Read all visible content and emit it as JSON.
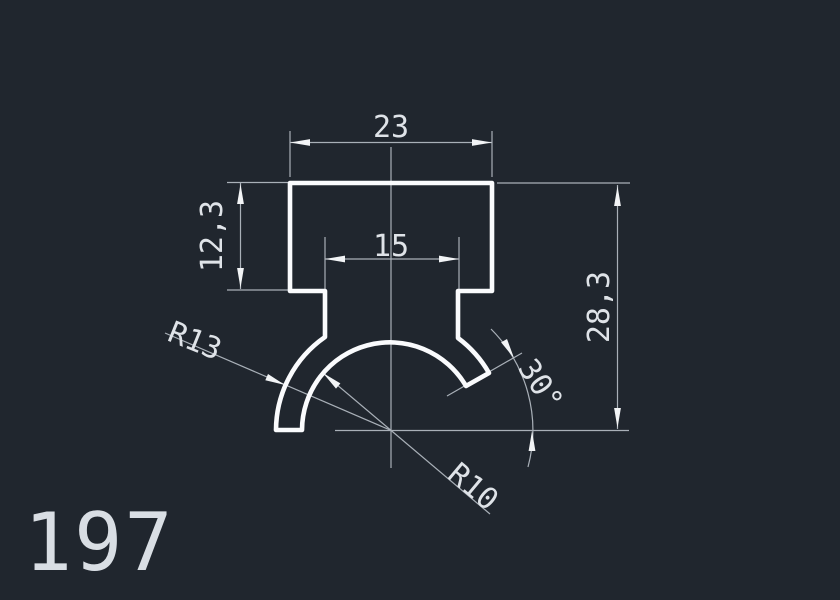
{
  "drawing": {
    "part_number": "197",
    "dimensions": {
      "top_width": "23",
      "slot_width": "15",
      "head_height": "12,3",
      "total_height": "28,3",
      "outer_radius": "R13",
      "inner_radius": "R10",
      "cut_angle": "30°"
    },
    "colors": {
      "background": "#20262e",
      "outline": "#fafbfd",
      "dimension_lines": "#a9b0b8",
      "arrows": "#f2f4f6",
      "text": "#dfe3e8"
    }
  }
}
